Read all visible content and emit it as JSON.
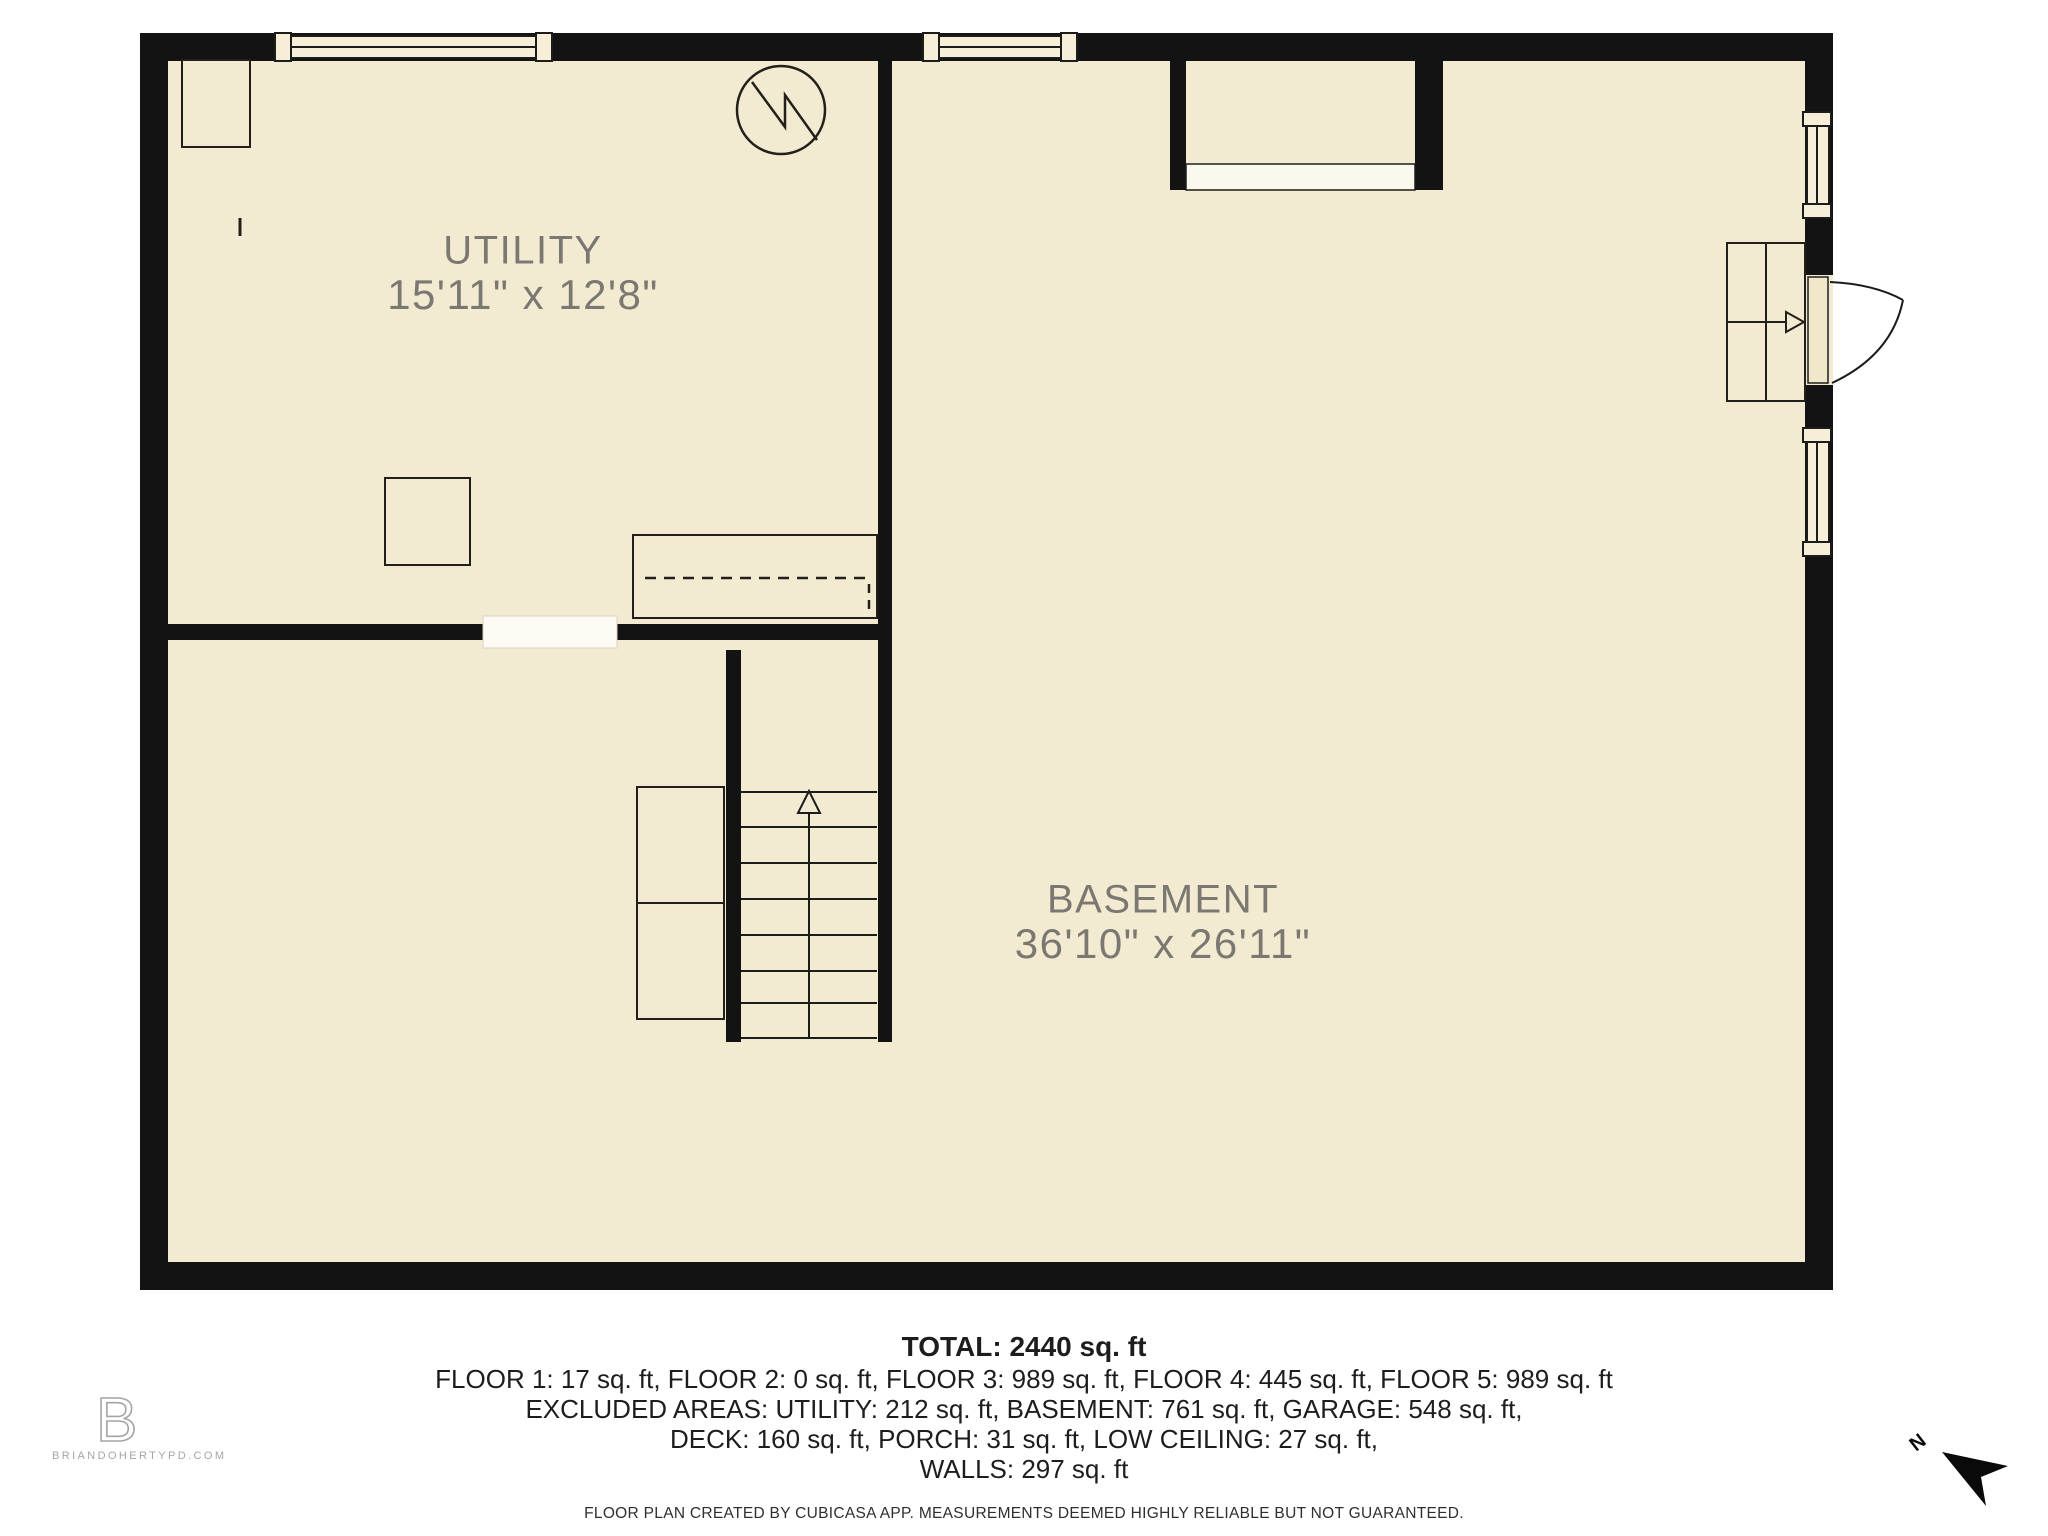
{
  "rooms": [
    {
      "name": "UTILITY",
      "dimensions": "15'11\" x 12'8\""
    },
    {
      "name": "BASEMENT",
      "dimensions": "36'10\" x 26'11\""
    }
  ],
  "summary": {
    "total": "TOTAL: 2440 sq. ft",
    "floors": "FLOOR 1: 17 sq. ft, FLOOR 2: 0 sq. ft, FLOOR 3: 989 sq. ft, FLOOR 4: 445 sq. ft, FLOOR 5: 989 sq. ft",
    "excluded": "EXCLUDED AREAS: UTILITY: 212 sq. ft, BASEMENT: 761 sq. ft, GARAGE: 548 sq. ft,",
    "excluded2": "DECK: 160 sq. ft, PORCH: 31 sq. ft, LOW CEILING: 27 sq. ft,",
    "walls": "WALLS: 297 sq. ft",
    "disclaimer": "FLOOR PLAN CREATED BY CUBICASA APP. MEASUREMENTS DEEMED HIGHLY RELIABLE BUT NOT GUARANTEED."
  },
  "branding": {
    "logo_letter": "B",
    "website": "BRIANDOHERTYPD.COM"
  },
  "compass": {
    "north_label": "N"
  },
  "colors": {
    "floor": "#f3ebd1",
    "wall": "#131313",
    "room_label": "#7b7872",
    "window_fill": "#f6eed6"
  }
}
